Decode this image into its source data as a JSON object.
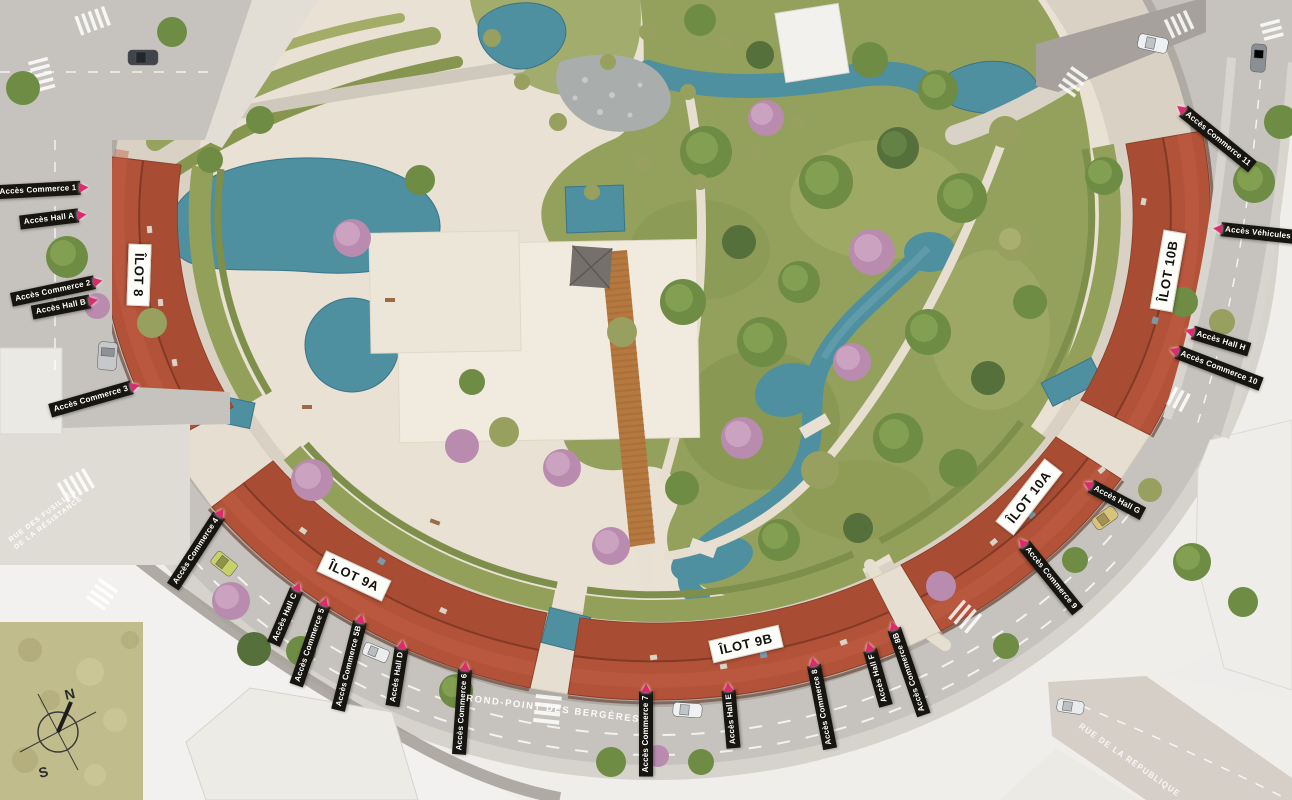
{
  "plan_title": "Site plan — Rond-Point des Bergères",
  "labels": {
    "access": [
      "Accès Commerce 1",
      "Accès Hall A",
      "Accès Commerce 2",
      "Accès Hall B",
      "Accès Commerce 3",
      "Accès Commerce 4",
      "Accès Hall C",
      "Accès Commerce 5",
      "Accès Commerce 5B",
      "Accès Hall D",
      "Accès Commerce 6",
      "Accès Commerce 7",
      "Accès Hall E",
      "Accès Commerce 8",
      "Accès Hall F",
      "Accès Commerce 8B",
      "Accès Commerce 9",
      "Accès Hall G",
      "Accès Commerce 10",
      "Accès Hall H",
      "Accès Véhicules",
      "Accès Commerce 11"
    ],
    "blocks": [
      "ÎLOT 8",
      "ÎLOT 9A",
      "ÎLOT 9B",
      "ÎLOT 10A",
      "ÎLOT 10B"
    ]
  },
  "streets": {
    "rue_fusilles_1": "RUE DES FUSILLÉS",
    "rue_fusilles_2": "DE LA RÉSISTANCE",
    "rond_point": "ROND-POINT DES BERGÈRES",
    "rue_republique": "RUE DE LA RÉPUBLIQUE"
  },
  "compass": {
    "north": "N",
    "south": "S"
  },
  "colors": {
    "access_chip_bg": "#17150f",
    "access_chip_text": "#ffffff",
    "access_arrow": "#dc2a6e",
    "block_chip_bg": "#fdfdfa",
    "block_chip_text": "#14120d",
    "roof": "#b25238",
    "water": "#4e8fa0",
    "lawn": "#94a15c",
    "plaza": "#e9e1d3",
    "road": "#c6c2bd"
  }
}
